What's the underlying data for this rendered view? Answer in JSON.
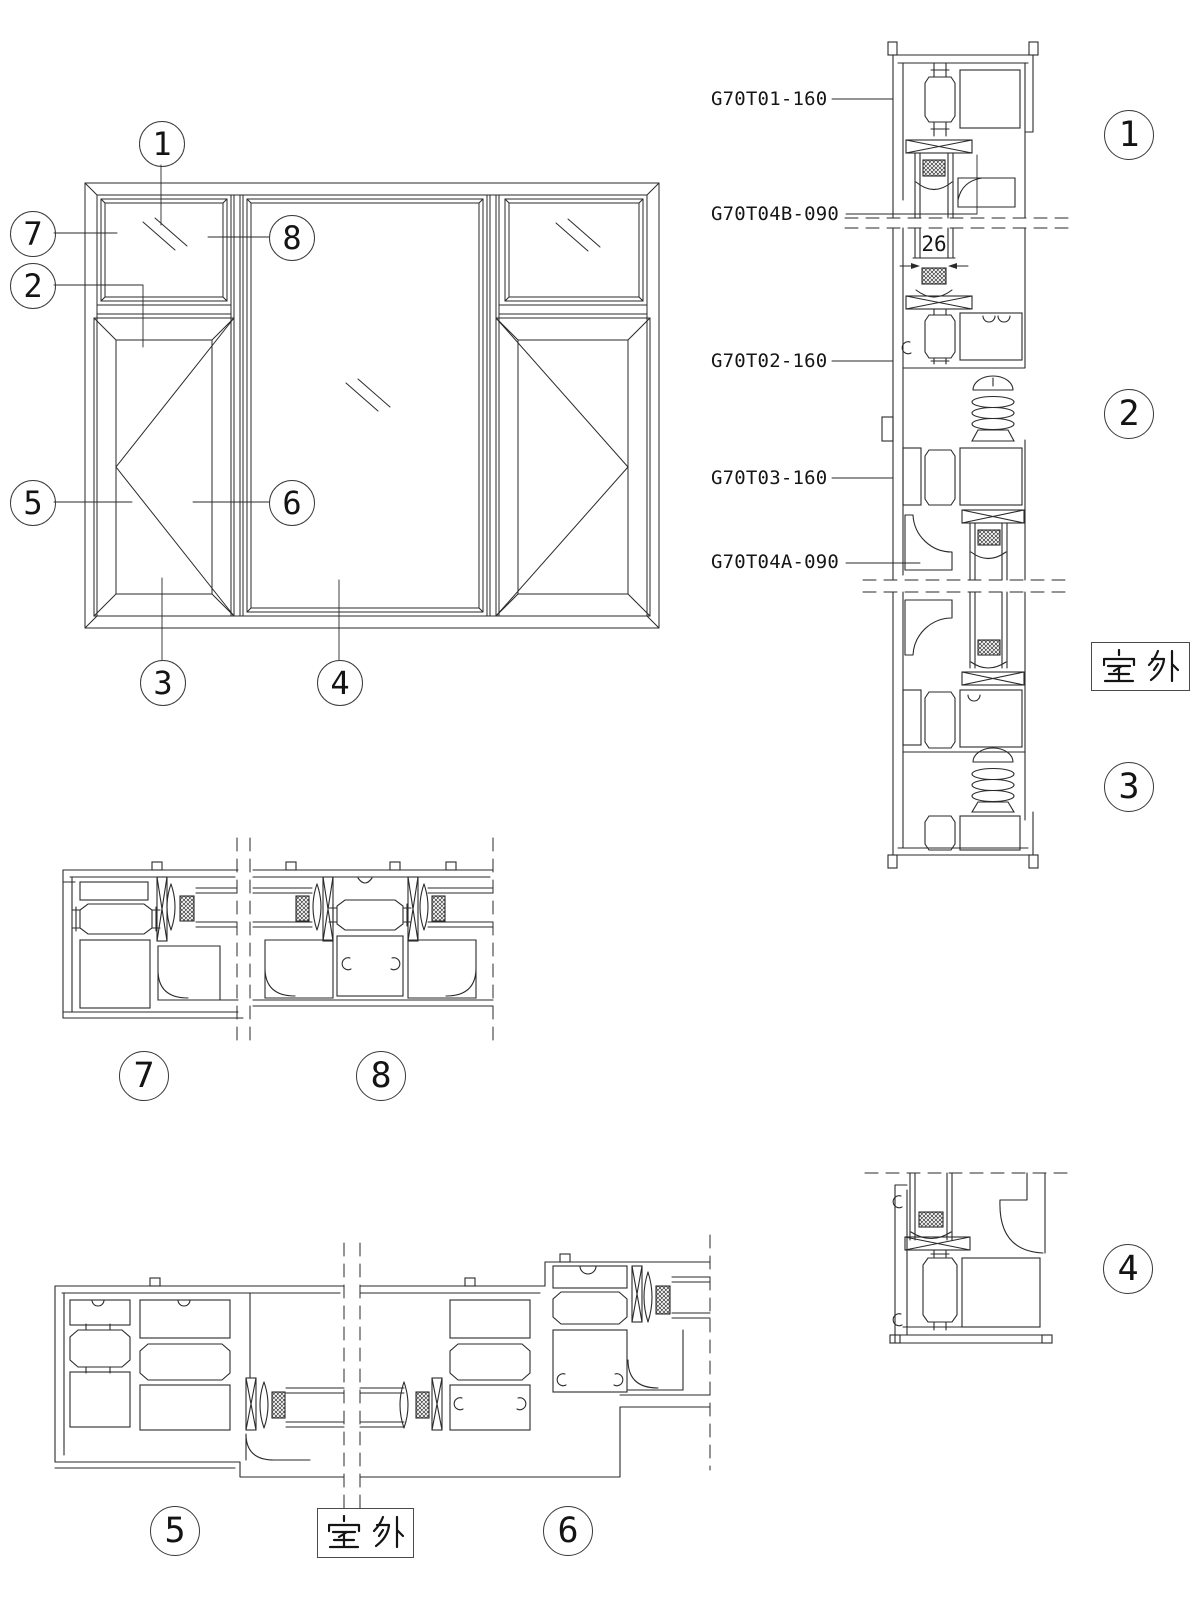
{
  "page": {
    "bg": "#ffffff",
    "ink": "#222222"
  },
  "part_labels": [
    {
      "text": "G70T01-160"
    },
    {
      "text": "G70T04B-090"
    },
    {
      "text": "G70T02-160"
    },
    {
      "text": "G70T03-160"
    },
    {
      "text": "G70T04A-090"
    }
  ],
  "dimension": {
    "value": "26"
  },
  "outdoor_boxes": [
    {
      "text": "室外"
    },
    {
      "text": "室外"
    }
  ],
  "elevation_callouts": [
    {
      "num": "1"
    },
    {
      "num": "7"
    },
    {
      "num": "2"
    },
    {
      "num": "5"
    },
    {
      "num": "8"
    },
    {
      "num": "6"
    },
    {
      "num": "3"
    },
    {
      "num": "4"
    }
  ],
  "section_markers": [
    {
      "num": "1"
    },
    {
      "num": "2"
    },
    {
      "num": "3"
    },
    {
      "num": "4"
    },
    {
      "num": "7"
    },
    {
      "num": "8"
    },
    {
      "num": "5"
    },
    {
      "num": "6"
    }
  ]
}
